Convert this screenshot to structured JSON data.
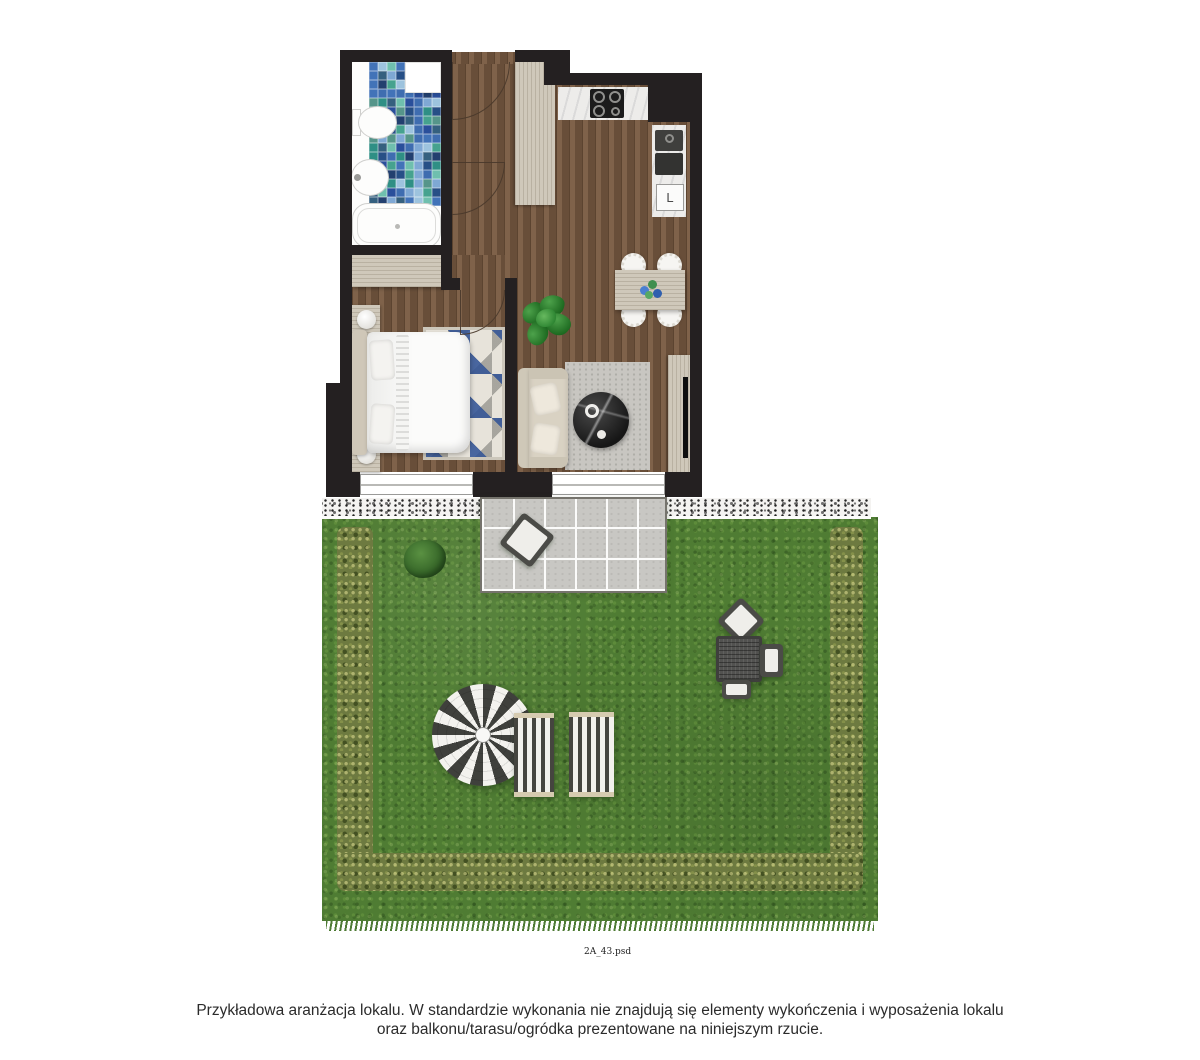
{
  "caption": {
    "line1": "Przykładowa aranżacja lokalu. W standardzie wykonania nie znajdują się elementy wykończenia i wyposażenia lokalu",
    "line2": "oraz balkonu/tarasu/ogródka prezentowane na niniejszym rzucie."
  },
  "plan": {
    "file_label": "2A_43.psd",
    "fridge_label": "L"
  },
  "colors": {
    "wall": "#242021",
    "wood_floor": "#74573f",
    "light_wood": "#cfc8ba",
    "marble": "#edecea",
    "living_rug": "#c8c6c1",
    "rug_blue": "#335496",
    "grass": "#4f7c33",
    "hedge": "#6d7a40",
    "gravel": "#f4f3f1",
    "terrace_tile": "#c8c7c3",
    "umbrella_dark": "#3f403c",
    "text": "#2b2b2b"
  },
  "mosaic": {
    "cols": 8,
    "rows": 16,
    "cell_px": 9,
    "palette": [
      "#2a4f9b",
      "#4273b8",
      "#7fa8d4",
      "#2f8f85",
      "#46a28f",
      "#6fbfae",
      "#23406f",
      "#3f6db0",
      "#56958a",
      "#9dc3de",
      "#35607f",
      "#274f86"
    ]
  }
}
